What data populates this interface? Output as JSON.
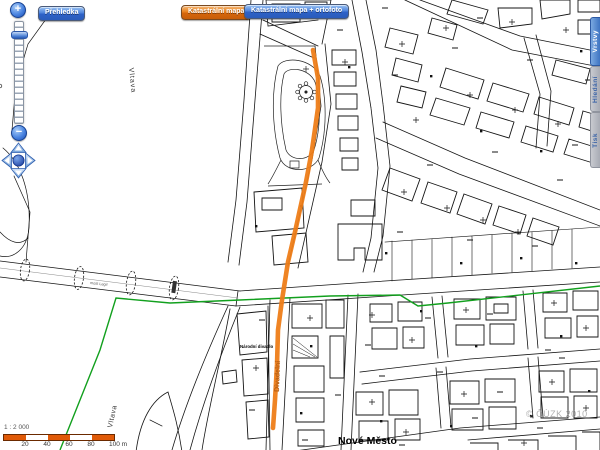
{
  "toolbar": {
    "overview_button": "Přehledka",
    "cadastral_map_button": "Katastrální mapa",
    "cadastral_ortho_button": "Katastrální mapa + ortofoto"
  },
  "side_tabs": [
    {
      "label": "Vrstvy",
      "active": true
    },
    {
      "label": "Hledání",
      "active": false
    },
    {
      "label": "Tisk",
      "active": false
    }
  ],
  "zoom_control": {
    "zoom_in_label": "+",
    "zoom_out_label": "−"
  },
  "scale_bar": {
    "ratio": "1 : 2 000",
    "ticks": [
      "20",
      "40",
      "60",
      "80",
      "100 m"
    ]
  },
  "map_labels": {
    "river_upper": "Vltava",
    "river_lower": "Vltava",
    "district": "Nové Město",
    "street_route": "Divadelní",
    "landmark": "Národní divadlo",
    "bridge": "most Legií",
    "copyright": "© ČÚZK 2010"
  },
  "colors": {
    "route_orange": "#ee7d18",
    "boundary_green": "#12a01e",
    "scalebar_orange": "#e05a08",
    "button_blue": "#2e62c8",
    "button_orange": "#d5660c",
    "tab_blue": "#3e74c2",
    "tab_gray": "#b0b3bc"
  }
}
